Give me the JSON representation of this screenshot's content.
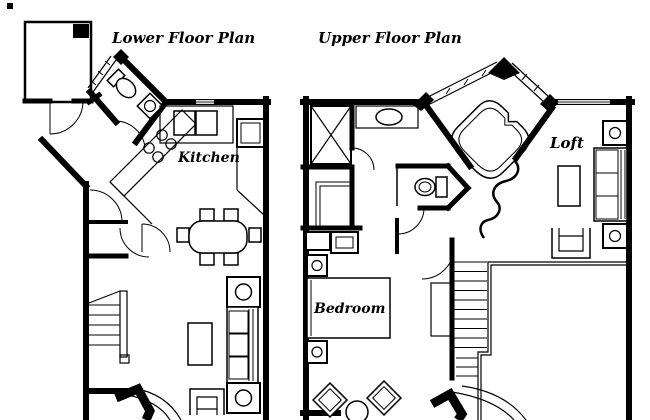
{
  "canvas": {
    "background": "#ffffff",
    "ink": "#000000",
    "window_glass_gray": "#8c8c8c"
  },
  "plans": {
    "lower": {
      "title": "Lower Floor Plan",
      "labels": {
        "kitchen": "Kitchen"
      },
      "symbols": [
        "entry-room",
        "entry-door",
        "powder-room-toilet",
        "powder-room-sink",
        "window-hatch",
        "kitchen-sink",
        "refrigerator",
        "stove-burners",
        "diagonal-counter",
        "dining-table",
        "dining-chairs",
        "sofa",
        "end-table-lamp",
        "coffee-table",
        "armchair",
        "staircase",
        "bay-window"
      ]
    },
    "upper": {
      "title": "Upper Floor Plan",
      "labels": {
        "bedroom": "Bedroom",
        "loft": "Loft"
      },
      "symbols": [
        "shower-x",
        "vanity-sink",
        "corner-tub",
        "tub-windows",
        "toilet",
        "closet-rods",
        "dresser",
        "bed",
        "nightstand-lamp",
        "accent-chairs",
        "round-table",
        "staircase",
        "open-to-below-rail",
        "sofa",
        "end-table-lamp",
        "coffee-table",
        "armchair",
        "bay-window",
        "wall-window"
      ]
    }
  }
}
